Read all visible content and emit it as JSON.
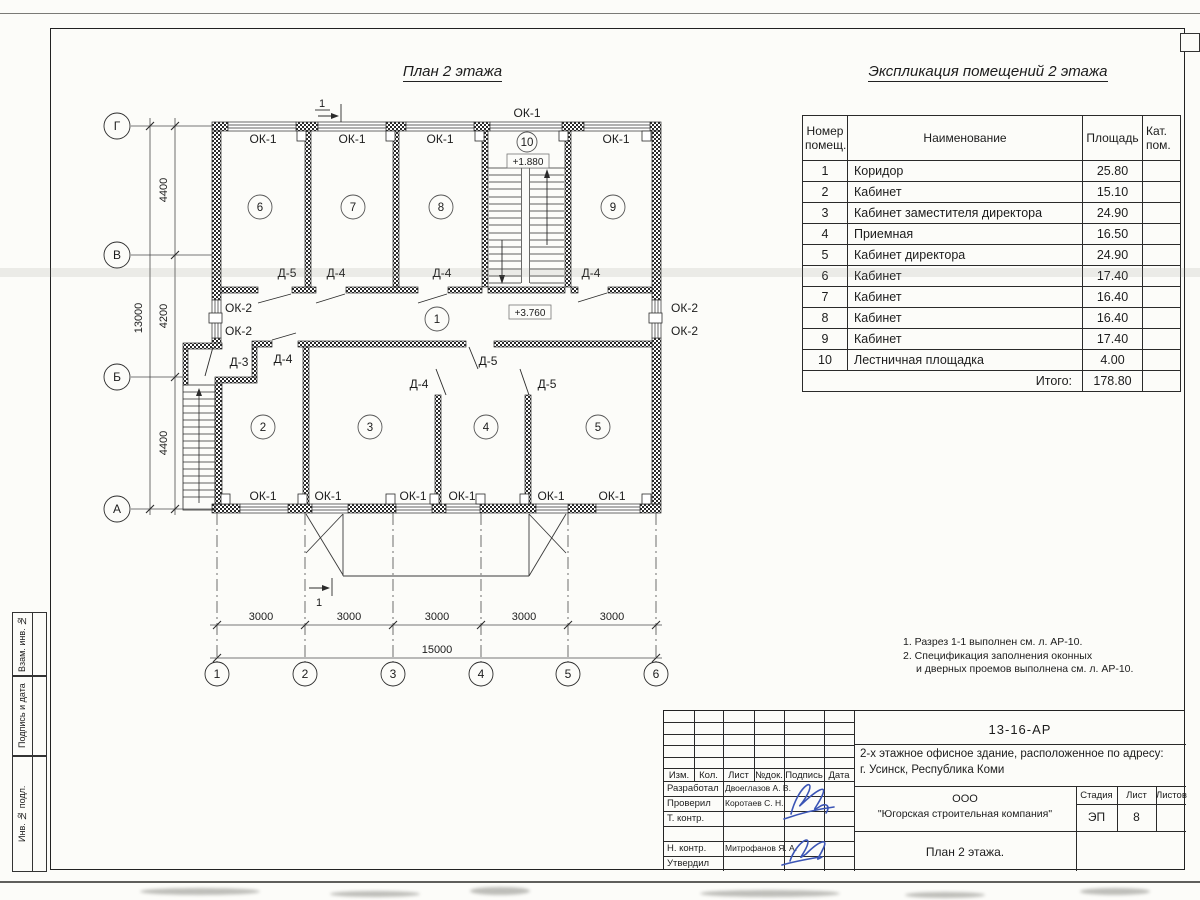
{
  "sheet": {
    "plan_title": "План 2 этажа",
    "explication_title": "Экспликация помещений 2 этажа",
    "notes": [
      "1. Разрез 1-1 выполнен см. л. АР-10.",
      "2. Спецификация заполнения оконных",
      "и дверных проемов выполнена см. л. АР-10."
    ]
  },
  "accents": {
    "signature_ink": "#3b55b5",
    "line": "#2b2b2b",
    "paper": "#fcfcf9"
  },
  "explication": {
    "headers": [
      "Номер помещ.",
      "Наименование",
      "Площадь",
      "Кат. пом."
    ],
    "rows": [
      [
        "1",
        "Коридор",
        "25.80",
        ""
      ],
      [
        "2",
        "Кабинет",
        "15.10",
        ""
      ],
      [
        "3",
        "Кабинет заместителя директора",
        "24.90",
        ""
      ],
      [
        "4",
        "Приемная",
        "16.50",
        ""
      ],
      [
        "5",
        "Кабинет директора",
        "24.90",
        ""
      ],
      [
        "6",
        "Кабинет",
        "17.40",
        ""
      ],
      [
        "7",
        "Кабинет",
        "16.40",
        ""
      ],
      [
        "8",
        "Кабинет",
        "16.40",
        ""
      ],
      [
        "9",
        "Кабинет",
        "17.40",
        ""
      ],
      [
        "10",
        "Лестничная площадка",
        "4.00",
        ""
      ]
    ],
    "total_label": "Итого:",
    "total_value": "178.80"
  },
  "plan": {
    "axis_letters": [
      "Г",
      "В",
      "Б",
      "А"
    ],
    "axis_numbers": [
      "1",
      "2",
      "3",
      "4",
      "5",
      "6"
    ],
    "dim_vertical": [
      "4400",
      "4200",
      "4400"
    ],
    "dim_vertical_total": "13000",
    "dim_horizontal": [
      "3000",
      "3000",
      "3000",
      "3000",
      "3000"
    ],
    "dim_horizontal_total": "15000",
    "rooms": [
      "1",
      "2",
      "3",
      "4",
      "5",
      "6",
      "7",
      "8",
      "9",
      "10"
    ],
    "window_ok1": "ОК-1",
    "window_ok2": "ОК-2",
    "door_d3": "Д-3",
    "door_d4": "Д-4",
    "door_d5": "Д-5",
    "elevation_stair": "+1.880",
    "elevation_corridor": "+3.760",
    "section_mark": "1"
  },
  "titleblock": {
    "doc_number": "13-16-АР",
    "project_line1": "2-х этажное офисное здание, расположенное по адресу:",
    "project_line2": "г. Усинск, Республика Коми",
    "org_line1": "ООО",
    "org_line2": "\"Югорская строительная компания\"",
    "stage_label": "Стадия",
    "stage_value": "ЭП",
    "sheet_label": "Лист",
    "sheet_value": "8",
    "sheets_label": "Листов",
    "drawing_title": "План 2 этажа.",
    "col_headers": [
      "Изм.",
      "Кол.",
      "Лист",
      "№док.",
      "Подпись",
      "Дата"
    ],
    "roles": [
      {
        "role": "Разработал",
        "name": "Двоеглазов А. В."
      },
      {
        "role": "Проверил",
        "name": "Коротаев С. Н."
      },
      {
        "role": "Т. контр.",
        "name": ""
      },
      {
        "role": "Н. контр.",
        "name": "Митрофанов Я. А."
      },
      {
        "role": "Утвердил",
        "name": ""
      }
    ]
  },
  "margin_stamp": [
    "Взам. инв. №",
    "Подпись и дата",
    "Инв. № подл."
  ]
}
